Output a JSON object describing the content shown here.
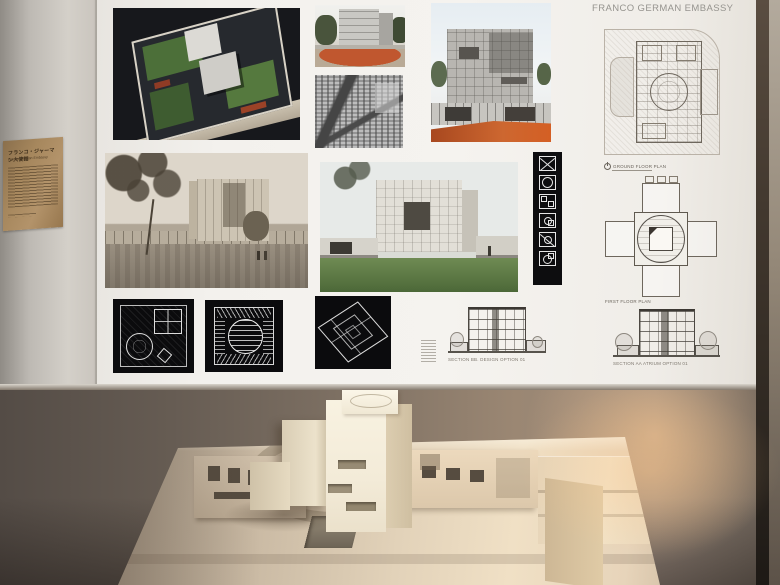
{
  "board": {
    "title": "FRANCO GERMAN EMBASSY"
  },
  "label_panel": {
    "heading": "フランコ・ジャーマン大使館",
    "subheading": "Franco German Embassy"
  },
  "captions": {
    "ground_floor_plan": "GROUND FLOOR PLAN",
    "first_floor_plan": "FIRST FLOOR PLAN",
    "section_left": "SECTION BB. DESIGN OPTION 01",
    "section_right": "SECTION AA ATRIUM OPTION 01"
  },
  "icons": {
    "parti_diagrams": [
      "square-x",
      "square-circle",
      "four-rooms",
      "circle-with-rooms",
      "x-with-circle",
      "circle-plan"
    ]
  },
  "palette": {
    "accent_terracotta": "#c0572f",
    "lawn_green": "#5d7a44",
    "poster_white": "#f3f1ed",
    "lower_wall_taupe": "#827466",
    "label_panel_tan": "#a6875d",
    "model_cream": "#f3ebd8",
    "diagram_black": "#0b0b0d"
  }
}
